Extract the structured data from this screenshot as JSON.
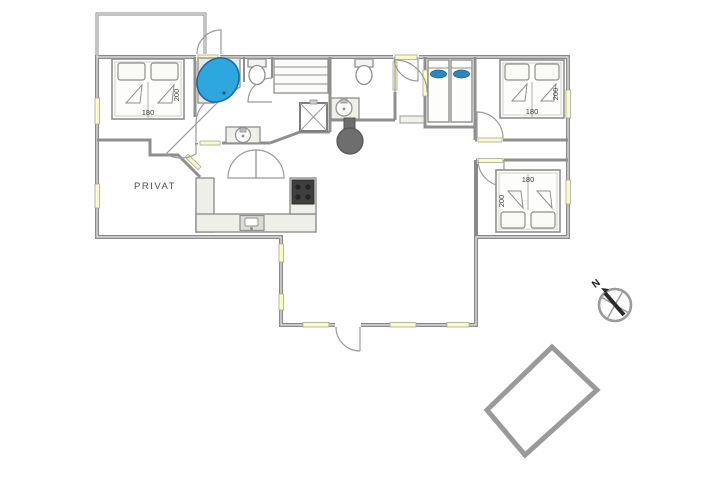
{
  "plan_type": "house-floor-plan",
  "private_room": {
    "label": "PRIVAT"
  },
  "bedrooms": [
    {
      "id": "bedroom-1",
      "position": "top-left",
      "width_label": "180",
      "length_label": "200"
    },
    {
      "id": "bedroom-2",
      "position": "top-right",
      "width_label": "180",
      "length_label": "200"
    },
    {
      "id": "bedroom-3",
      "position": "right",
      "width_label": "180",
      "length_label": "200"
    }
  ],
  "compass": {
    "north_label": "N"
  },
  "fixtures": [
    "corner-bathtub",
    "toilet",
    "toilet",
    "washbasin",
    "washbasin",
    "sauna-benches",
    "shower-cabin",
    "bunk-beds",
    "kitchen-stove",
    "kitchen-sink",
    "wood-stove",
    "terrace",
    "compass-rose"
  ],
  "colors": {
    "wall_gray": "#898989",
    "wall_light": "#e9e9e5",
    "window_yellow": "#fbfbc8",
    "bathtub_blue": "#2ea7df",
    "pillow_blue": "#2e86c1",
    "stove_dark": "#3f3f3f",
    "wood_stove_gray": "#6e6e6e",
    "fixture_fill": "#efefe9"
  }
}
